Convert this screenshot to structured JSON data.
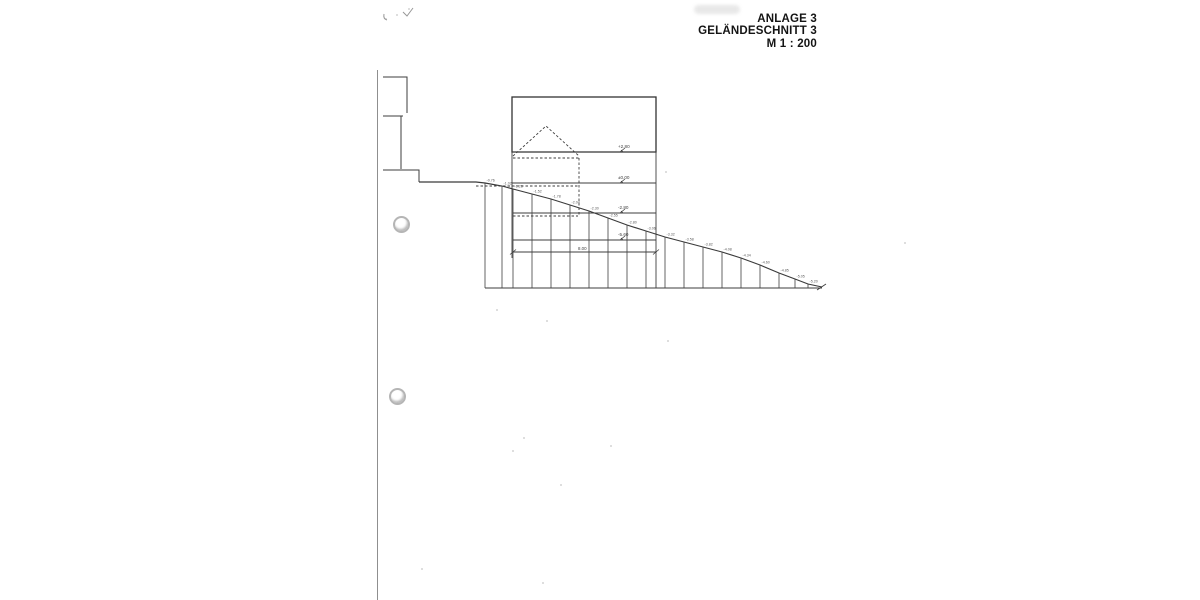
{
  "scan": {
    "title_block": {
      "lines": [
        "ANLAGE 3",
        "GELÄNDESCHNITT 3",
        "M 1 : 200"
      ]
    }
  },
  "drawing": {
    "colors": {
      "ink": "#3e3e3e",
      "faint": "#979797",
      "spot": "#5a5a5a"
    },
    "levels": [
      {
        "label": "+2.80",
        "x": 618,
        "text_y": 148,
        "line_y": 152
      },
      {
        "label": "±0.00",
        "x": 618,
        "text_y": 179,
        "line_y": 183
      },
      {
        "label": "-2.80",
        "x": 618,
        "text_y": 209,
        "line_y": 213
      },
      {
        "label": "-5.60",
        "x": 618,
        "text_y": 236,
        "line_y": 240
      }
    ],
    "dimension": {
      "label": "8.00",
      "x": 578,
      "y": 250,
      "line_y": 252,
      "x1": 513,
      "x2": 656
    },
    "spot_elevations": [
      "-0.76",
      "-1.02",
      "-1.28",
      "-1.52",
      "-1.78",
      "-2.04",
      "-2.30",
      "-2.55",
      "-2.80",
      "-3.06",
      "-3.32",
      "-3.58",
      "-3.82",
      "-4.08",
      "-4.34",
      "-4.60",
      "-4.85",
      "-5.05",
      "-5.20"
    ],
    "geometry": {
      "building_rect": [
        512,
        97,
        144,
        55
      ],
      "walls": [
        [
          512,
          152,
          512,
          258
        ],
        [
          656,
          152,
          656,
          288
        ]
      ],
      "h_lines": [
        [
          152,
          512,
          656
        ],
        [
          183,
          512,
          656
        ],
        [
          213,
          513,
          656
        ],
        [
          240,
          513,
          656
        ]
      ],
      "solids": [
        [
          [
            383,
            77
          ],
          [
            407,
            77
          ],
          [
            407,
            113
          ]
        ],
        [
          [
            383,
            116
          ],
          [
            403,
            116
          ]
        ],
        [
          [
            401,
            116
          ],
          [
            401,
            169
          ]
        ],
        [
          [
            383,
            170
          ],
          [
            419,
            170
          ],
          [
            419,
            182
          ]
        ]
      ],
      "dashed": [
        [
          [
            513,
            156
          ],
          [
            546,
            126
          ],
          [
            579,
            156
          ]
        ],
        [
          [
            513,
            158
          ],
          [
            579,
            158
          ]
        ],
        [
          [
            579,
            158
          ],
          [
            579,
            216
          ]
        ],
        [
          [
            476,
            186
          ],
          [
            578,
            186
          ]
        ],
        [
          [
            513,
            216
          ],
          [
            578,
            216
          ]
        ]
      ],
      "terrain": [
        [
          419,
          182
        ],
        [
          476,
          182
        ],
        [
          485,
          183
        ],
        [
          502,
          186
        ],
        [
          513,
          189
        ],
        [
          532,
          194
        ],
        [
          551,
          199
        ],
        [
          570,
          205
        ],
        [
          589,
          211
        ],
        [
          608,
          218
        ],
        [
          627,
          225
        ],
        [
          646,
          231
        ],
        [
          665,
          237
        ],
        [
          684,
          242
        ],
        [
          703,
          247
        ],
        [
          722,
          252
        ],
        [
          741,
          258
        ],
        [
          760,
          265
        ],
        [
          779,
          273
        ],
        [
          795,
          279
        ],
        [
          808,
          284
        ],
        [
          822,
          287
        ]
      ],
      "baseline_y": 288,
      "baseline_x1": 485,
      "baseline_x2": 822,
      "hatch_x": [
        485,
        502,
        513,
        532,
        551,
        570,
        589,
        608,
        627,
        646,
        665,
        684,
        703,
        722,
        741,
        760,
        779,
        795,
        808
      ],
      "end_tick": "M817 290 l9 -6",
      "marks": [
        "M403 12 l4 4 l6 -8",
        "M384 14 q-1 5 3 6"
      ],
      "speckles": [
        [
          409,
          9
        ],
        [
          397,
          15
        ],
        [
          386,
          19
        ],
        [
          547,
          321
        ],
        [
          666,
          172
        ],
        [
          524,
          438
        ],
        [
          513,
          451
        ],
        [
          561,
          485
        ],
        [
          611,
          446
        ],
        [
          543,
          583
        ],
        [
          668,
          341
        ],
        [
          422,
          569
        ],
        [
          497,
          310
        ],
        [
          905,
          243
        ]
      ]
    }
  }
}
